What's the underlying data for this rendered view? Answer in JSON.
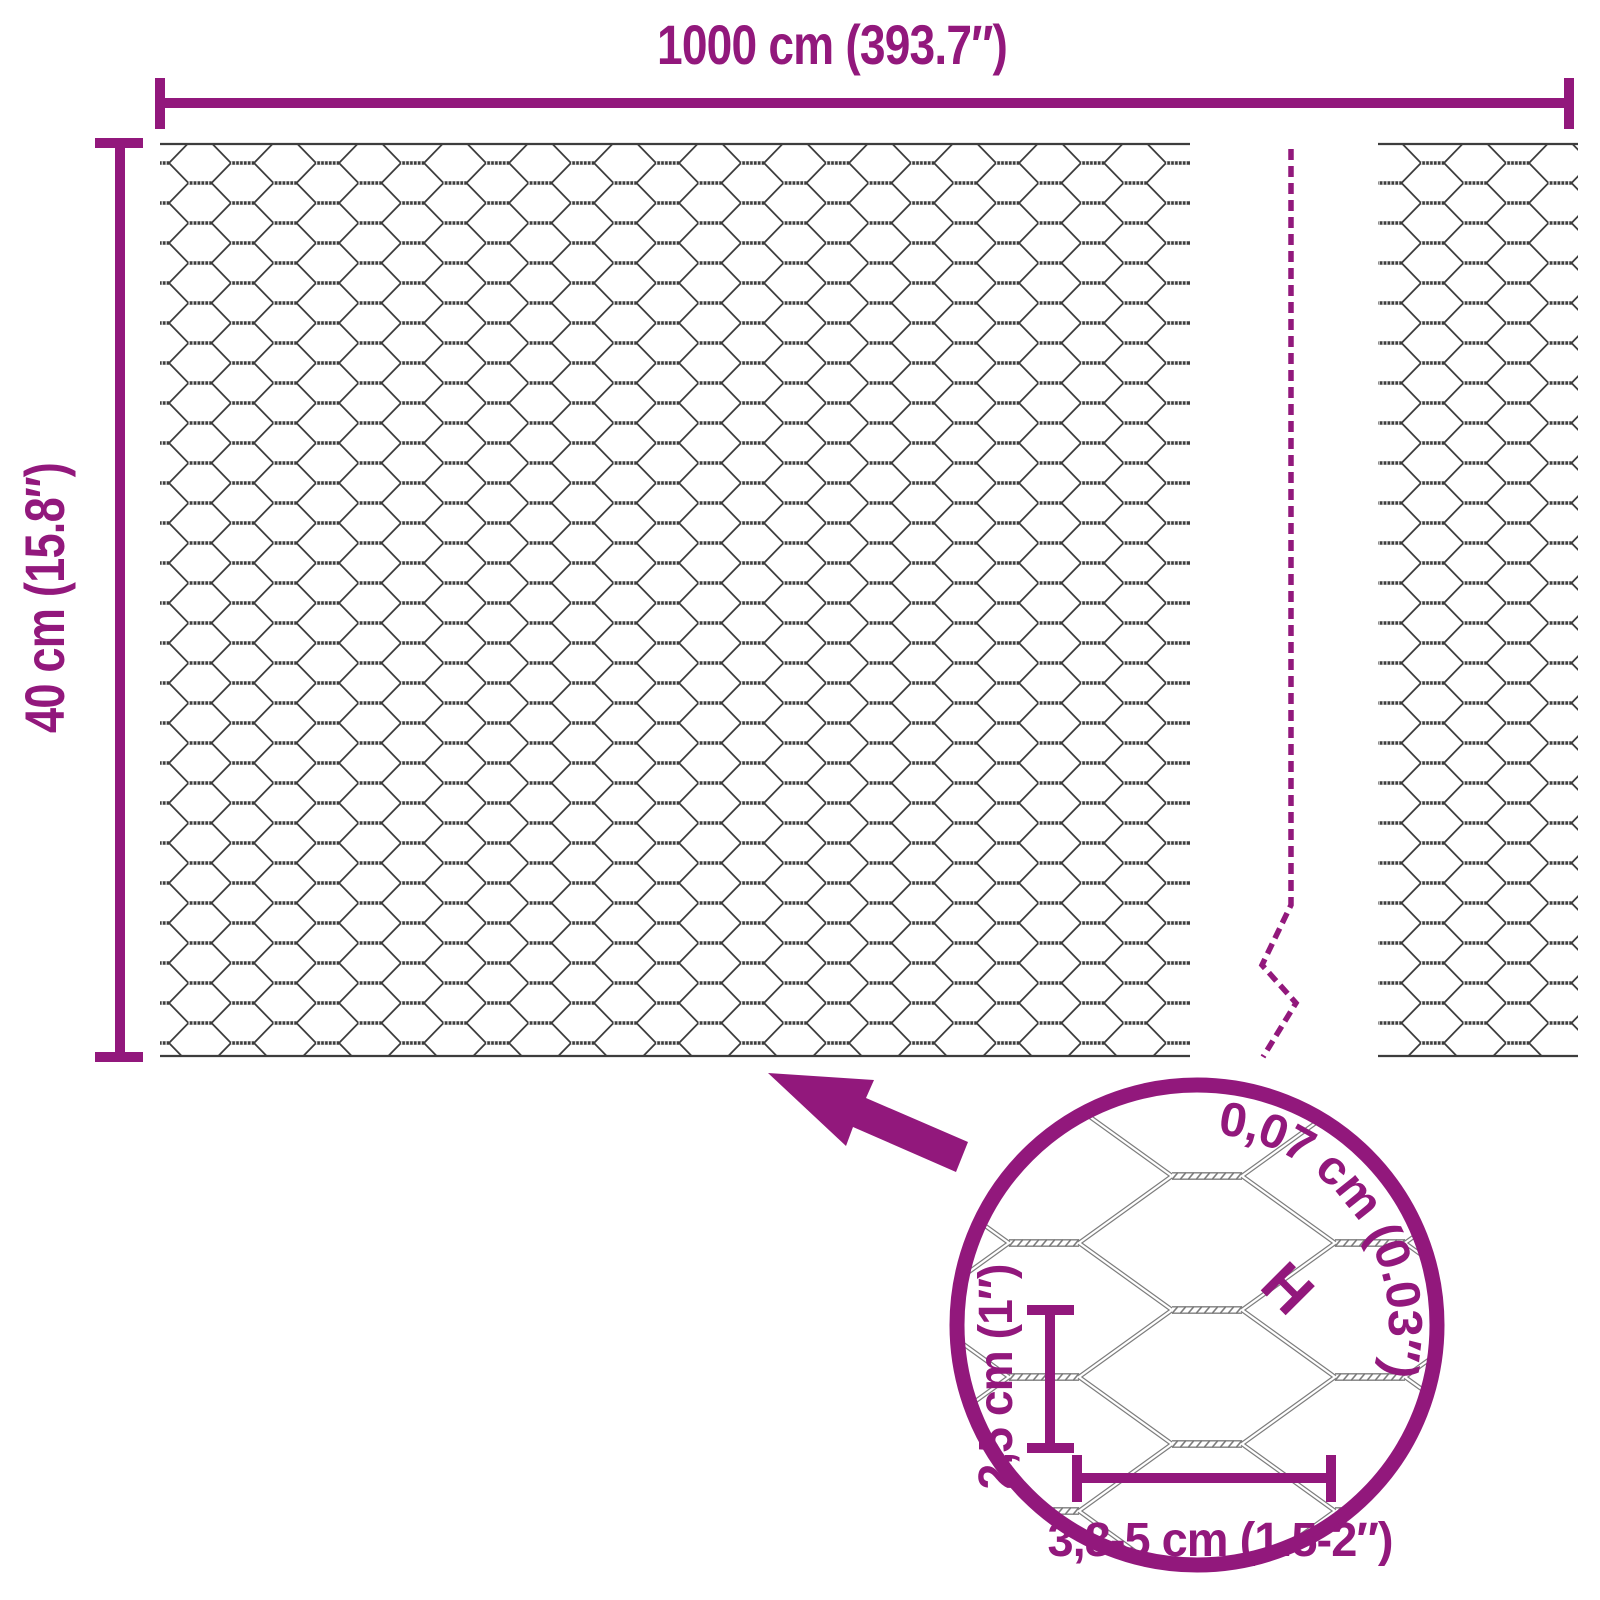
{
  "meta": {
    "description": "Hexagonal wire mesh (chicken wire) product dimensions diagram"
  },
  "colors": {
    "accent": "#92187c",
    "wire": "#3d3d3d",
    "wire_detail": "#7d7d7d",
    "background": "#ffffff"
  },
  "labels": {
    "total_width": "1000 cm (393.7″)",
    "total_height": "40 cm (15.8″)",
    "wire_thickness": "0,07 cm (0.03″)",
    "wire_thickness_symbol": "H",
    "mesh_cell_height": "2,5 cm (1″)",
    "mesh_cell_width": "3,8-5 cm (1.5-2″)"
  }
}
